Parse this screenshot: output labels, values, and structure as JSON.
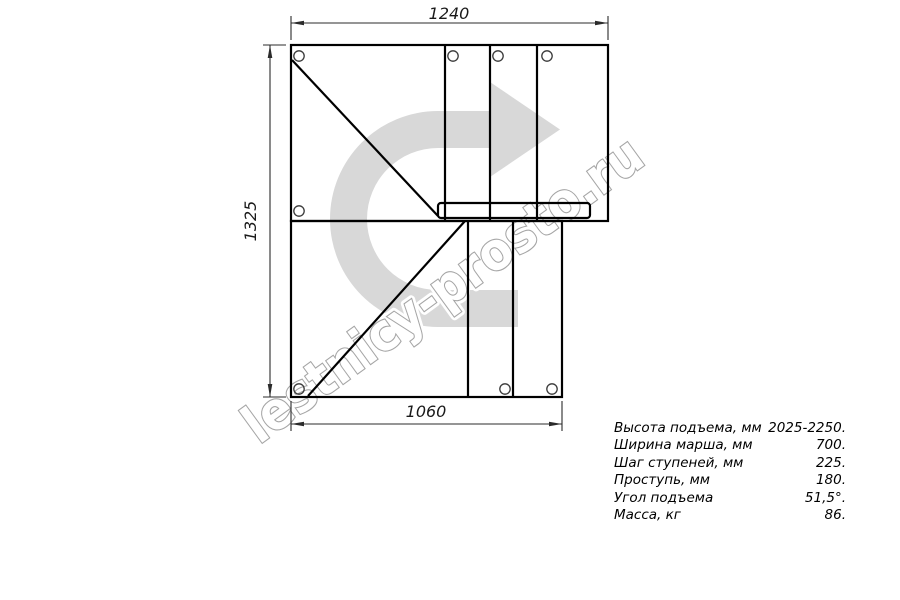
{
  "drawing": {
    "title": "staircase-plan-top-view",
    "dim_top": "1240",
    "dim_left": "1325",
    "dim_bottom": "1060"
  },
  "watermark": {
    "text": "lestnicy-prosto.ru"
  },
  "specs": {
    "rows": [
      {
        "label": "Высота подъема, мм",
        "value": "2025-2250."
      },
      {
        "label": "Ширина марша, мм",
        "value": "700."
      },
      {
        "label": "Шаг ступеней, мм",
        "value": "225."
      },
      {
        "label": "Проступь, мм",
        "value": "180."
      },
      {
        "label": "Угол подъема",
        "value": "51,5°."
      },
      {
        "label": "Масса, кг",
        "value": "86."
      }
    ]
  },
  "colors": {
    "line": "#000000",
    "dim_line": "#2b2b2b",
    "arrow_fill": "#d8d8d8",
    "watermark_outline": "#a5a5a5",
    "background": "#ffffff"
  }
}
